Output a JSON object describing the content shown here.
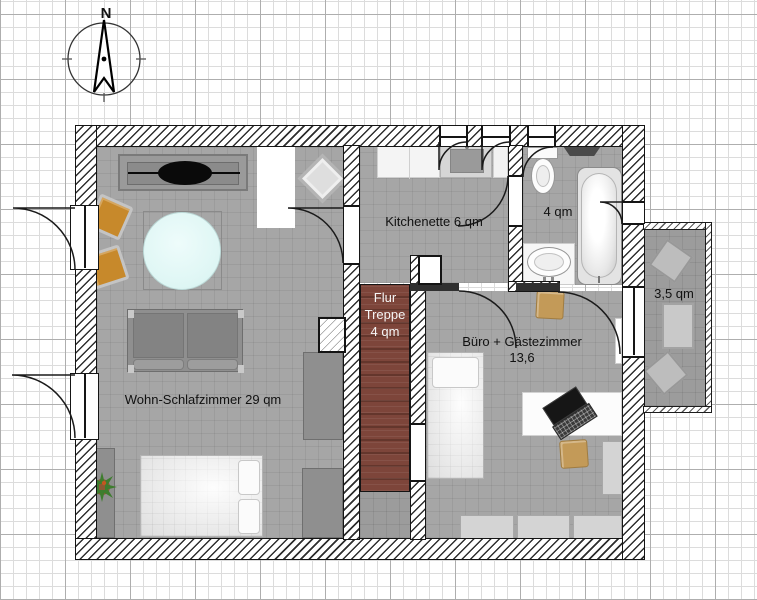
{
  "compass": {
    "north_label": "N"
  },
  "rooms": {
    "wohn": {
      "label": "Wohn-Schlafzimmer 29 qm"
    },
    "kitchenette": {
      "label": "Kitchenette 6 qm"
    },
    "bad": {
      "label": "4 qm"
    },
    "flur": {
      "line1": "Flur",
      "line2": "Treppe",
      "line3": "4 qm"
    },
    "buero": {
      "line1": "Büro + Gästezimmer",
      "line2": "13,6"
    },
    "balkon": {
      "label": "3,5 qm"
    }
  },
  "colors": {
    "floor": "#a6a6a6",
    "floor_dark": "#9c9c9c",
    "stairs": "#7d453a",
    "stairs_stripe": "#64362c",
    "chair_orange": "#c7892b",
    "chair_tan": "#c39a58",
    "table_glass": "#def6f4",
    "wall_line": "#1a1a1a"
  }
}
